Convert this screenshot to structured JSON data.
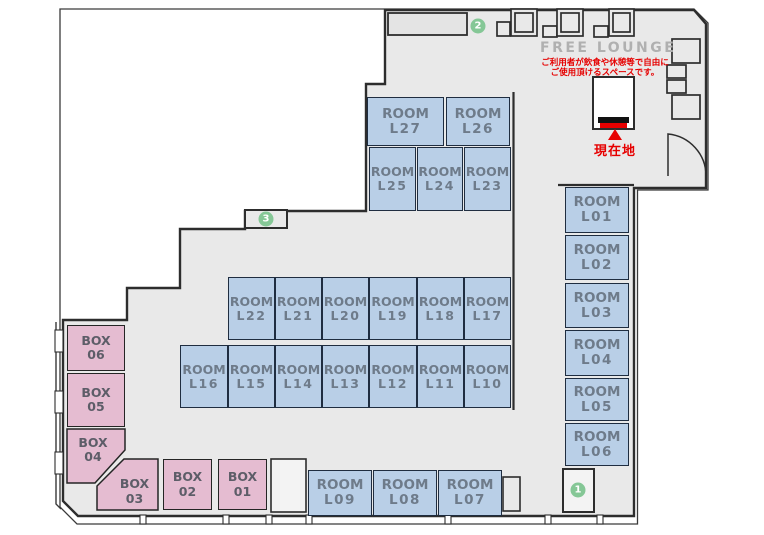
{
  "lounge": {
    "title": "FREE LOUNGE",
    "note_line1": "ご利用者が飲食や休憩等で自由に",
    "note_line2": "ご使用頂けるスペースです。"
  },
  "current_location": {
    "label": "現在地"
  },
  "colors": {
    "room_fill": "#b9cfe7",
    "room_border": "#1f2d40",
    "room_text": "#6e7b8a",
    "box_fill": "#e5bcd1",
    "box_text": "#5d5d68",
    "floor": "#e9e9e9",
    "wall": "#2d2d2d",
    "marker_green": "#85c796",
    "accent_red": "#e60000",
    "lounge_text": "#b0b0b0"
  },
  "rooms": [
    {
      "name": "ROOM",
      "num": "L27",
      "x": 367,
      "y": 97,
      "w": 77,
      "h": 49
    },
    {
      "name": "ROOM",
      "num": "L26",
      "x": 446,
      "y": 97,
      "w": 64,
      "h": 49
    },
    {
      "name": "ROOM",
      "num": "L25",
      "x": 369,
      "y": 147,
      "w": 47,
      "h": 64
    },
    {
      "name": "ROOM",
      "num": "L24",
      "x": 417,
      "y": 147,
      "w": 46,
      "h": 64
    },
    {
      "name": "ROOM",
      "num": "L23",
      "x": 464,
      "y": 147,
      "w": 47,
      "h": 64
    },
    {
      "name": "ROOM",
      "num": "L22",
      "x": 228,
      "y": 277,
      "w": 47,
      "h": 63
    },
    {
      "name": "ROOM",
      "num": "L21",
      "x": 275,
      "y": 277,
      "w": 47,
      "h": 63
    },
    {
      "name": "ROOM",
      "num": "L20",
      "x": 322,
      "y": 277,
      "w": 47,
      "h": 63
    },
    {
      "name": "ROOM",
      "num": "L19",
      "x": 369,
      "y": 277,
      "w": 48,
      "h": 63
    },
    {
      "name": "ROOM",
      "num": "L18",
      "x": 417,
      "y": 277,
      "w": 47,
      "h": 63
    },
    {
      "name": "ROOM",
      "num": "L17",
      "x": 464,
      "y": 277,
      "w": 47,
      "h": 63
    },
    {
      "name": "ROOM",
      "num": "L16",
      "x": 180,
      "y": 345,
      "w": 48,
      "h": 63
    },
    {
      "name": "ROOM",
      "num": "L15",
      "x": 228,
      "y": 345,
      "w": 47,
      "h": 63
    },
    {
      "name": "ROOM",
      "num": "L14",
      "x": 275,
      "y": 345,
      "w": 47,
      "h": 63
    },
    {
      "name": "ROOM",
      "num": "L13",
      "x": 322,
      "y": 345,
      "w": 47,
      "h": 63
    },
    {
      "name": "ROOM",
      "num": "L12",
      "x": 369,
      "y": 345,
      "w": 48,
      "h": 63
    },
    {
      "name": "ROOM",
      "num": "L11",
      "x": 417,
      "y": 345,
      "w": 47,
      "h": 63
    },
    {
      "name": "ROOM",
      "num": "L10",
      "x": 464,
      "y": 345,
      "w": 47,
      "h": 63
    },
    {
      "name": "ROOM",
      "num": "L01",
      "x": 565,
      "y": 187,
      "w": 64,
      "h": 46
    },
    {
      "name": "ROOM",
      "num": "L02",
      "x": 565,
      "y": 235,
      "w": 64,
      "h": 45
    },
    {
      "name": "ROOM",
      "num": "L03",
      "x": 565,
      "y": 283,
      "w": 64,
      "h": 45
    },
    {
      "name": "ROOM",
      "num": "L04",
      "x": 565,
      "y": 330,
      "w": 64,
      "h": 46
    },
    {
      "name": "ROOM",
      "num": "L05",
      "x": 565,
      "y": 378,
      "w": 64,
      "h": 43
    },
    {
      "name": "ROOM",
      "num": "L06",
      "x": 565,
      "y": 423,
      "w": 64,
      "h": 43
    },
    {
      "name": "ROOM",
      "num": "L09",
      "x": 308,
      "y": 470,
      "w": 64,
      "h": 46
    },
    {
      "name": "ROOM",
      "num": "L08",
      "x": 373,
      "y": 470,
      "w": 64,
      "h": 46
    },
    {
      "name": "ROOM",
      "num": "L07",
      "x": 438,
      "y": 470,
      "w": 64,
      "h": 46
    }
  ],
  "boxes": [
    {
      "name": "BOX",
      "num": "06",
      "x": 67,
      "y": 325,
      "w": 58,
      "h": 46,
      "shape": "rect"
    },
    {
      "name": "BOX",
      "num": "05",
      "x": 67,
      "y": 373,
      "w": 58,
      "h": 54,
      "shape": "rect"
    },
    {
      "name": "BOX",
      "num": "04",
      "x": 67,
      "y": 429,
      "w": 58,
      "h": 54,
      "shape": "poly",
      "pad": "0 6px 12px 0"
    },
    {
      "name": "BOX",
      "num": "03",
      "x": 95,
      "y": 459,
      "w": 63,
      "h": 51,
      "shape": "poly",
      "pad": "14px 0 0 16px"
    },
    {
      "name": "BOX",
      "num": "02",
      "x": 163,
      "y": 459,
      "w": 49,
      "h": 51,
      "shape": "rect"
    },
    {
      "name": "BOX",
      "num": "01",
      "x": 218,
      "y": 459,
      "w": 49,
      "h": 51,
      "shape": "rect"
    }
  ],
  "markers": [
    {
      "num": "1",
      "cx": 578,
      "cy": 490
    },
    {
      "num": "2",
      "cx": 478,
      "cy": 26
    },
    {
      "num": "3",
      "cx": 266,
      "cy": 219
    }
  ]
}
